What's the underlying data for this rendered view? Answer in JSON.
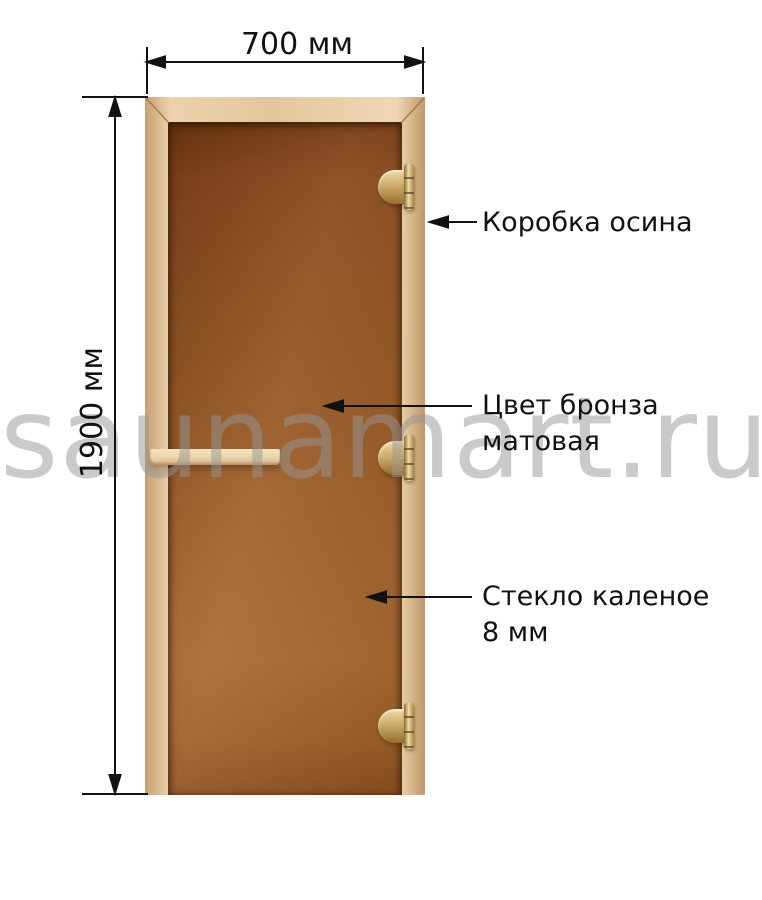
{
  "watermark": {
    "text": "saunamart.ru",
    "color": "#cbcbcb"
  },
  "dimensions": {
    "width": {
      "label": "700 мм",
      "value_mm": 700
    },
    "height": {
      "label": "1900 мм",
      "value_mm": 1900
    }
  },
  "callouts": {
    "frame": {
      "lines": [
        "Коробка осина"
      ]
    },
    "glass_color": {
      "lines": [
        "Цвет бронза",
        "матовая"
      ]
    },
    "glass_spec": {
      "lines": [
        "Стекло каленое",
        "8 мм"
      ]
    }
  },
  "door": {
    "frame_wood_color": "#e8cda6",
    "glass_bronze_color": "#9a5a26",
    "hinge_brass_color": "#c9a86a",
    "hinge_count": 3
  },
  "line_color": "#111111"
}
